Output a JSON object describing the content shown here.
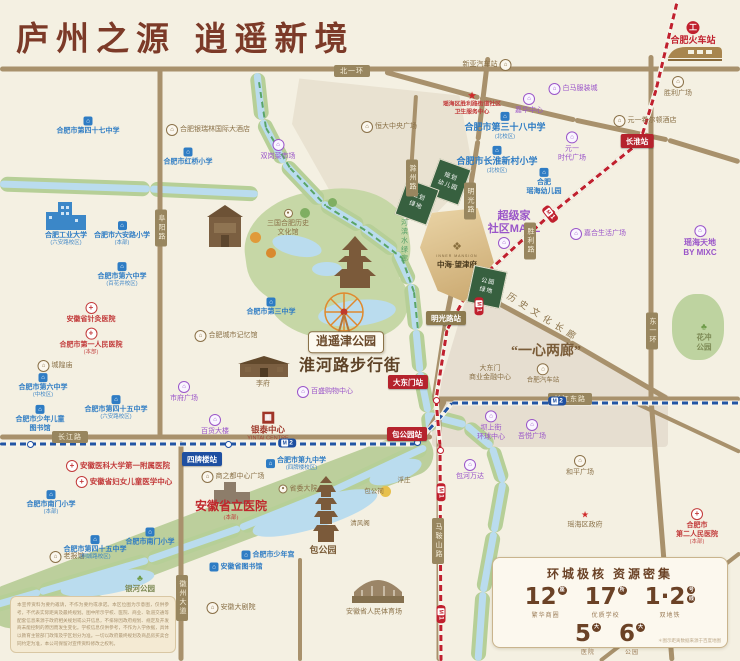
{
  "title": "庐州之源  逍遥新境",
  "project": {
    "name_en": "INNER MANSION",
    "name": "中海·望津府",
    "logo": "❖"
  },
  "colors": {
    "accent_brown": "#7c3a28",
    "school_blue": "#2e7cc4",
    "hospital_red": "#c23a3a",
    "mall_purple": "#9a55c9",
    "landmark_brown": "#8a7148",
    "metro1_red": "#c0202e",
    "metro2_blue": "#1e4fa1",
    "road_tan": "#a8916c",
    "river_blue": "#badcee",
    "park_green": "#c6d7a6",
    "gold": "#d9bd8c"
  },
  "stats": {
    "title": "环城极核  资源密集",
    "items": [
      {
        "num": "12",
        "unit": "座",
        "label": "繁华商圈"
      },
      {
        "num": "17",
        "unit": "所",
        "label": "优质学校"
      },
      {
        "num": "1·2",
        "units": [
          "号",
          "线"
        ],
        "label": "双地铁"
      },
      {
        "num": "5",
        "unit": "大",
        "label": "医院"
      },
      {
        "num": "6",
        "unit": "大",
        "label": "公园"
      }
    ],
    "note": "＊图示距离数据来源于百度地图"
  },
  "disclaimer": "本宣传资料为要约邀请，不作为要约或承诺。本区位图为示意图，仅供参考，不代表实际距离及最终规划。图中所示学校、医院、商业、轨道交通等配套信息来源于政府相关规划或公开信息，不排除因政府规划、规定及开发商未能控制的原因而发生变化。学校信息仅供参考，不作为入学依据，具体以教育主管部门政策及学区划分为准。一切以政府最终规划及商品房买卖合同约定为准，本公司保留对宣传资料修改之权利。",
  "planning_blocks": [
    {
      "lines": [
        "规划",
        "幼儿园"
      ],
      "x": 449,
      "y": 182,
      "rot": 20
    },
    {
      "lines": [
        "规划",
        "绿地"
      ],
      "x": 417,
      "y": 202,
      "rot": 20
    },
    {
      "lines": [
        "公园",
        "绿地"
      ],
      "x": 487,
      "y": 287,
      "rot": 12
    }
  ],
  "road_badges": [
    {
      "t": "北一环",
      "x": 352,
      "y": 71
    },
    {
      "t": "长江路",
      "x": 70,
      "y": 437
    },
    {
      "t": "长江东路",
      "x": 570,
      "y": 399
    },
    {
      "t": "阜阳路",
      "x": 161,
      "y": 228,
      "v": 1
    },
    {
      "t": "东一环",
      "x": 652,
      "y": 331,
      "v": 1
    },
    {
      "t": "徽州大道",
      "x": 182,
      "y": 598,
      "v": 1
    },
    {
      "t": "马鞍山路",
      "x": 438,
      "y": 541,
      "v": 1
    },
    {
      "t": "滁州路",
      "x": 412,
      "y": 178,
      "v": 1
    },
    {
      "t": "明光路",
      "x": 470,
      "y": 201,
      "v": 1
    },
    {
      "t": "胜利路",
      "x": 530,
      "y": 241,
      "v": 1
    }
  ],
  "stations": [
    {
      "t": "长淮站",
      "x": 637,
      "y": 141,
      "line": "l1"
    },
    {
      "t": "明光路站",
      "x": 446,
      "y": 318,
      "line": "lt"
    },
    {
      "t": "大东门站",
      "x": 408,
      "y": 382,
      "line": "l1"
    },
    {
      "t": "包公园站",
      "x": 407,
      "y": 434,
      "line": "l1"
    },
    {
      "t": "四牌楼站",
      "x": 202,
      "y": 459,
      "line": "l2"
    }
  ],
  "metro_badges": [
    {
      "n": "2",
      "line": "l2",
      "x": 287,
      "y": 443
    },
    {
      "n": "2",
      "line": "l2",
      "x": 557,
      "y": 401
    },
    {
      "n": "1",
      "line": "l1",
      "x": 550,
      "y": 214,
      "rot": 52
    },
    {
      "n": "1",
      "line": "l1",
      "x": 479,
      "y": 306,
      "rot": 90
    },
    {
      "n": "1",
      "line": "l1",
      "x": 441,
      "y": 492,
      "rot": 90
    },
    {
      "n": "1",
      "line": "l1",
      "x": 441,
      "y": 614,
      "rot": 90
    }
  ],
  "labels": [
    {
      "t": "合肥市第四十七中学",
      "x": 88,
      "y": 126,
      "c": "sch",
      "i": "school"
    },
    {
      "t": "合肥银瑞林国际大酒店",
      "x": 208,
      "y": 130,
      "c": "lm",
      "i": "lm",
      "ip": "left"
    },
    {
      "t": "合肥市红桥小学",
      "x": 188,
      "y": 157,
      "c": "sch",
      "i": "school"
    },
    {
      "t": "合肥工业大学",
      "s": "(六安路校区)",
      "x": 66,
      "y": 239,
      "c": "sch"
    },
    {
      "t": "合肥市六安路小学",
      "s": "(本部)",
      "x": 122,
      "y": 234,
      "c": "sch",
      "i": "school"
    },
    {
      "t": "合肥市第六中学",
      "s": "(百花井校区)",
      "x": 122,
      "y": 275,
      "c": "sch",
      "i": "school"
    },
    {
      "t": "安徽省针灸医院",
      "x": 91,
      "y": 313,
      "c": "hos",
      "i": "hosp"
    },
    {
      "t": "合肥市第一人民医院",
      "s": "(本部)",
      "x": 91,
      "y": 342,
      "c": "hos",
      "i": "hosp"
    },
    {
      "t": "城隍庙",
      "x": 55,
      "y": 366,
      "c": "lm",
      "i": "lm",
      "ip": "left"
    },
    {
      "t": "合肥市第六中学",
      "s": "(中校区)",
      "x": 43,
      "y": 386,
      "c": "sch",
      "i": "school"
    },
    {
      "lines": [
        "合肥市少年儿童",
        "图书馆"
      ],
      "x": 40,
      "y": 419,
      "c": "sch",
      "i": "school"
    },
    {
      "t": "合肥市第四十五中学",
      "s": "(六安路校区)",
      "x": 116,
      "y": 408,
      "c": "sch",
      "i": "school"
    },
    {
      "t": "合肥城市记忆馆",
      "x": 226,
      "y": 336,
      "c": "lm",
      "i": "lm",
      "ip": "left"
    },
    {
      "t": "市府广场",
      "x": 184,
      "y": 392,
      "c": "mall",
      "i": "mall"
    },
    {
      "t": "百货大楼",
      "x": 215,
      "y": 425,
      "c": "mall",
      "i": "mall"
    },
    {
      "t": "合肥市第三中学",
      "x": 271,
      "y": 307,
      "c": "sch",
      "i": "school"
    },
    {
      "t": "李府",
      "x": 263,
      "y": 384,
      "c": "lm"
    },
    {
      "t": "百盛购物中心",
      "x": 325,
      "y": 392,
      "c": "mall",
      "i": "mall",
      "ip": "left"
    },
    {
      "t": "银泰中心",
      "s": "YINTAI CENTRE",
      "x": 268,
      "y": 427,
      "c": "yintai",
      "i": "yintai"
    },
    {
      "t": "淮河路步行街",
      "x": 350,
      "y": 367,
      "c": "huge"
    },
    {
      "t": "逍遥津公园",
      "x": 346,
      "y": 342,
      "c": "parkbox"
    },
    {
      "lines": [
        "三国合肥历史",
        "文化馆"
      ],
      "x": 288,
      "y": 223,
      "c": "lm",
      "i": "dot"
    },
    {
      "t": "双岗菜市场",
      "x": 278,
      "y": 150,
      "c": "mall",
      "i": "mall"
    },
    {
      "t": "恒大中央广场",
      "x": 389,
      "y": 127,
      "c": "lm",
      "i": "lm",
      "ip": "left"
    },
    {
      "t": "新亚汽车站",
      "x": 487,
      "y": 65,
      "c": "lm",
      "i": "lm",
      "ip": "right"
    },
    {
      "lines": [
        "瑶海区胜利路街道社区",
        "卫生服务中心"
      ],
      "x": 472,
      "y": 104,
      "c": "hosS",
      "i": "star"
    },
    {
      "t": "白马服装城",
      "x": 573,
      "y": 89,
      "c": "mall",
      "i": "mall",
      "ip": "left"
    },
    {
      "t": "嘉华中心",
      "x": 529,
      "y": 104,
      "c": "mall",
      "i": "mall"
    },
    {
      "lines": [
        "元一",
        "时代广场"
      ],
      "x": 572,
      "y": 147,
      "c": "mall",
      "i": "mall"
    },
    {
      "t": "元一希尔顿酒店",
      "x": 645,
      "y": 121,
      "c": "lm",
      "i": "lm",
      "ip": "left"
    },
    {
      "t": "胜利广场",
      "x": 678,
      "y": 87,
      "c": "lm",
      "i": "lm"
    },
    {
      "t": "合肥火车站",
      "x": 693,
      "y": 34,
      "c": "rail",
      "i": "train"
    },
    {
      "t": "合肥市第三十八中学",
      "s": "(北校区)",
      "x": 505,
      "y": 126,
      "c": "schB",
      "i": "school"
    },
    {
      "t": "合肥市长淮新村小学",
      "s": "(北校区)",
      "x": 497,
      "y": 160,
      "c": "schB",
      "i": "school"
    },
    {
      "lines": [
        "合肥",
        "瑶海幼儿园"
      ],
      "x": 544,
      "y": 182,
      "c": "sch",
      "i": "school"
    },
    {
      "lines": [
        "超级家",
        "社区MALL"
      ],
      "x": 514,
      "y": 223,
      "c": "mallB"
    },
    {
      "i": "mall",
      "x": 504,
      "y": 243
    },
    {
      "t": "嘉合生活广场",
      "x": 598,
      "y": 234,
      "c": "mall",
      "i": "mall",
      "ip": "left"
    },
    {
      "lines": [
        "瑶海天地",
        "BY MIXC"
      ],
      "x": 700,
      "y": 242,
      "c": "mallM",
      "i": "mall"
    },
    {
      "lines": [
        "花冲",
        "公园"
      ],
      "x": 704,
      "y": 337,
      "c": "park",
      "i": "tree"
    },
    {
      "lines": [
        "大东门",
        "商业金融中心"
      ],
      "x": 490,
      "y": 373,
      "c": "lm"
    },
    {
      "t": "合肥汽车站",
      "x": 543,
      "y": 374,
      "c": "lmS",
      "i": "lm"
    },
    {
      "t": "“一心两廊”",
      "x": 546,
      "y": 352,
      "c": "big2"
    },
    {
      "t": "历史文化长廊",
      "x": 543,
      "y": 318,
      "c": "corridor",
      "rot": 32
    },
    {
      "t": "南淝河滨水绿廊",
      "x": 404,
      "y": 232,
      "c": "greenway"
    },
    {
      "t": "和平广场",
      "x": 580,
      "y": 466,
      "c": "lm",
      "i": "lm"
    },
    {
      "t": "瑶海区政府",
      "x": 585,
      "y": 520,
      "c": "lm",
      "i": "star"
    },
    {
      "lines": [
        "合肥市",
        "第二人民医院"
      ],
      "s": "(本部)",
      "x": 697,
      "y": 527,
      "c": "hos",
      "i": "hosp"
    },
    {
      "lines": [
        "合肥市",
        "裕丰花鸟虫鱼市场"
      ],
      "x": 545,
      "y": 572,
      "c": "lm"
    },
    {
      "i": "lm",
      "x": 548,
      "y": 592
    },
    {
      "lines": [
        "坝上街",
        "环球中心"
      ],
      "x": 491,
      "y": 426,
      "c": "mall",
      "i": "mall"
    },
    {
      "t": "吾悦广场",
      "x": 532,
      "y": 430,
      "c": "mall",
      "i": "mall"
    },
    {
      "t": "包河万达",
      "x": 470,
      "y": 470,
      "c": "mall",
      "i": "mall"
    },
    {
      "t": "安徽医科大学第一附属医院",
      "x": 118,
      "y": 466,
      "c": "hosM",
      "i": "hosp",
      "ip": "left"
    },
    {
      "t": "安徽省妇女儿童医学中心",
      "x": 124,
      "y": 482,
      "c": "hosM",
      "i": "hosp",
      "ip": "left"
    },
    {
      "t": "合肥市南门小学",
      "s": "(本部)",
      "x": 51,
      "y": 503,
      "c": "sch",
      "i": "school"
    },
    {
      "t": "合肥市南门小学",
      "x": 150,
      "y": 537,
      "c": "sch",
      "i": "school"
    },
    {
      "t": "合肥市第九中学",
      "s": "(四牌楼校区)",
      "x": 296,
      "y": 464,
      "c": "sch",
      "i": "school",
      "ip": "left"
    },
    {
      "t": "商之都中心广场",
      "x": 233,
      "y": 477,
      "c": "lm",
      "i": "lm",
      "ip": "left"
    },
    {
      "t": "安徽省立医院",
      "s": "(本部)",
      "x": 231,
      "y": 510,
      "c": "hosB"
    },
    {
      "t": "省委大院",
      "x": 298,
      "y": 489,
      "c": "lm",
      "i": "dot",
      "ip": "left"
    },
    {
      "t": "老报馆",
      "x": 67,
      "y": 557,
      "c": "lm",
      "i": "lm",
      "ip": "left"
    },
    {
      "t": "合肥市第四十五中学",
      "s": "(桐城路校区)",
      "x": 95,
      "y": 548,
      "c": "sch",
      "i": "school"
    },
    {
      "t": "合肥市少年宫",
      "x": 268,
      "y": 555,
      "c": "sch",
      "i": "school",
      "ip": "left"
    },
    {
      "t": "安徽省图书馆",
      "x": 236,
      "y": 567,
      "c": "sch",
      "i": "school",
      "ip": "left"
    },
    {
      "t": "银河公园",
      "x": 140,
      "y": 584,
      "c": "park",
      "i": "tree"
    },
    {
      "t": "安徽大剧院",
      "x": 231,
      "y": 608,
      "c": "lm",
      "i": "lm",
      "ip": "left"
    },
    {
      "t": "安徽省人民体育场",
      "x": 374,
      "y": 612,
      "c": "lm"
    },
    {
      "t": "包公园",
      "x": 323,
      "y": 551,
      "c": "lmB"
    },
    {
      "t": "清风阁",
      "x": 360,
      "y": 524,
      "c": "lmS"
    },
    {
      "t": "浮庄",
      "x": 404,
      "y": 481,
      "c": "lmS"
    },
    {
      "t": "包公祠",
      "x": 374,
      "y": 492,
      "c": "lmS"
    }
  ],
  "geometry": {
    "parcels": [
      {
        "x": 292,
        "y": 70,
        "w": 182,
        "h": 142,
        "clip": "polygon(4% 6%,92% 18%,100% 74%,80% 100%,26% 97%,0% 38%)",
        "color": "#e9e2d1"
      },
      {
        "x": 436,
        "y": 285,
        "w": 238,
        "h": 116,
        "clip": "polygon(14% 2%,100% 98%,0% 98%)",
        "color": "#e6ded0"
      },
      {
        "x": 432,
        "y": 401,
        "w": 236,
        "h": 46,
        "clip": "none",
        "color": "#e6ded0"
      }
    ],
    "park_blobs": [
      {
        "x": 245,
        "y": 190,
        "w": 165,
        "h": 118,
        "rot": -8,
        "color": "#c6d7a6"
      },
      {
        "x": 268,
        "y": 255,
        "w": 140,
        "h": 85,
        "rot": 6,
        "color": "#c6d7a6"
      },
      {
        "x": 672,
        "y": 294,
        "w": 52,
        "h": 66,
        "rot": 0,
        "color": "#bed3a0"
      }
    ],
    "park_bands": [
      [
        432,
        446,
        -10,
        614,
        44
      ]
    ],
    "rivers": [
      [
        0,
        184,
        150,
        189
      ],
      [
        150,
        189,
        258,
        194
      ],
      [
        257,
        73,
        262,
        120
      ],
      [
        262,
        120,
        284,
        163
      ],
      [
        284,
        163,
        322,
        203
      ],
      [
        322,
        203,
        362,
        227
      ],
      [
        362,
        227,
        396,
        252
      ],
      [
        396,
        252,
        411,
        284
      ],
      [
        411,
        284,
        416,
        330
      ],
      [
        416,
        330,
        420,
        372
      ],
      [
        420,
        372,
        428,
        412
      ],
      [
        428,
        412,
        430,
        432
      ],
      [
        426,
        447,
        330,
        492
      ],
      [
        330,
        492,
        240,
        528
      ],
      [
        240,
        528,
        148,
        560
      ],
      [
        148,
        560,
        40,
        592
      ],
      [
        40,
        592,
        -8,
        606
      ],
      [
        428,
        415,
        466,
        425
      ],
      [
        466,
        425,
        492,
        447
      ],
      [
        492,
        447,
        503,
        482
      ],
      [
        503,
        482,
        494,
        532
      ],
      [
        494,
        532,
        483,
        592
      ],
      [
        483,
        592,
        478,
        661
      ]
    ],
    "lakes": [
      {
        "x": 272,
        "y": 236,
        "w": 50,
        "h": 20,
        "rot": 12
      },
      {
        "x": 312,
        "y": 262,
        "w": 30,
        "h": 14,
        "rot": 0
      },
      {
        "x": 318,
        "y": 300,
        "w": 78,
        "h": 26,
        "rot": -6
      },
      {
        "x": 250,
        "y": 498,
        "w": 130,
        "h": 30,
        "rot": -17
      },
      {
        "x": 368,
        "y": 462,
        "w": 55,
        "h": 20,
        "rot": -20
      },
      {
        "x": 60,
        "y": 572,
        "w": 95,
        "h": 22,
        "rot": -10
      }
    ],
    "roads": [
      [
        0,
        69,
        740,
        69,
        5
      ],
      [
        160,
        69,
        160,
        437,
        5
      ],
      [
        0,
        437,
        432,
        437,
        5
      ],
      [
        432,
        399,
        740,
        399,
        5
      ],
      [
        651,
        55,
        651,
        399,
        5
      ],
      [
        651,
        399,
        672,
        661,
        5
      ],
      [
        181,
        441,
        181,
        661,
        5
      ],
      [
        300,
        558,
        300,
        661,
        4
      ],
      [
        385,
        72,
        480,
        98,
        5
      ],
      [
        480,
        98,
        575,
        120,
        5
      ],
      [
        575,
        120,
        668,
        140,
        5
      ],
      [
        668,
        140,
        740,
        162,
        5
      ],
      [
        488,
        57,
        478,
        140,
        5
      ],
      [
        478,
        140,
        462,
        240,
        5
      ],
      [
        462,
        240,
        446,
        320,
        5
      ],
      [
        446,
        320,
        434,
        399,
        5
      ],
      [
        640,
        142,
        552,
        213,
        5
      ],
      [
        552,
        213,
        470,
        288,
        5
      ],
      [
        470,
        288,
        570,
        342,
        5
      ],
      [
        570,
        342,
        668,
        399,
        5
      ],
      [
        439,
        399,
        439,
        661,
        5
      ],
      [
        416,
        95,
        408,
        220,
        4
      ],
      [
        627,
        399,
        740,
        452,
        4
      ],
      [
        600,
        661,
        740,
        553,
        4
      ],
      [
        425,
        437,
        445,
        400,
        5
      ]
    ],
    "metro2": [
      [
        0,
        444,
        415,
        444
      ],
      [
        415,
        444,
        438,
        420
      ],
      [
        438,
        420,
        452,
        403
      ],
      [
        452,
        403,
        740,
        403
      ]
    ],
    "metro1": [
      [
        679,
        -6,
        656,
        90
      ],
      [
        656,
        90,
        640,
        142
      ],
      [
        640,
        142,
        552,
        213
      ],
      [
        552,
        213,
        470,
        288
      ],
      [
        470,
        288,
        447,
        330
      ],
      [
        447,
        330,
        436,
        400
      ],
      [
        436,
        400,
        440,
        445
      ],
      [
        440,
        445,
        441,
        661
      ]
    ],
    "greenway": [
      [
        259,
        82,
        266,
        128
      ],
      [
        266,
        128,
        290,
        168
      ],
      [
        290,
        168,
        326,
        206
      ],
      [
        326,
        206,
        368,
        232
      ],
      [
        368,
        232,
        402,
        258
      ],
      [
        402,
        258,
        414,
        292
      ],
      [
        414,
        292,
        418,
        330
      ]
    ],
    "station_dots": [
      {
        "x": 30,
        "y": 444,
        "c": "#1e4fa1"
      },
      {
        "x": 228,
        "y": 444,
        "c": "#1e4fa1"
      },
      {
        "x": 417,
        "y": 442,
        "c": "#1e4fa1"
      },
      {
        "x": 640,
        "y": 142,
        "c": "#c0202e"
      },
      {
        "x": 447,
        "y": 318,
        "c": "#c0202e"
      },
      {
        "x": 436,
        "y": 400,
        "c": "#c0202e"
      },
      {
        "x": 440,
        "y": 450,
        "c": "#c0202e"
      }
    ]
  }
}
